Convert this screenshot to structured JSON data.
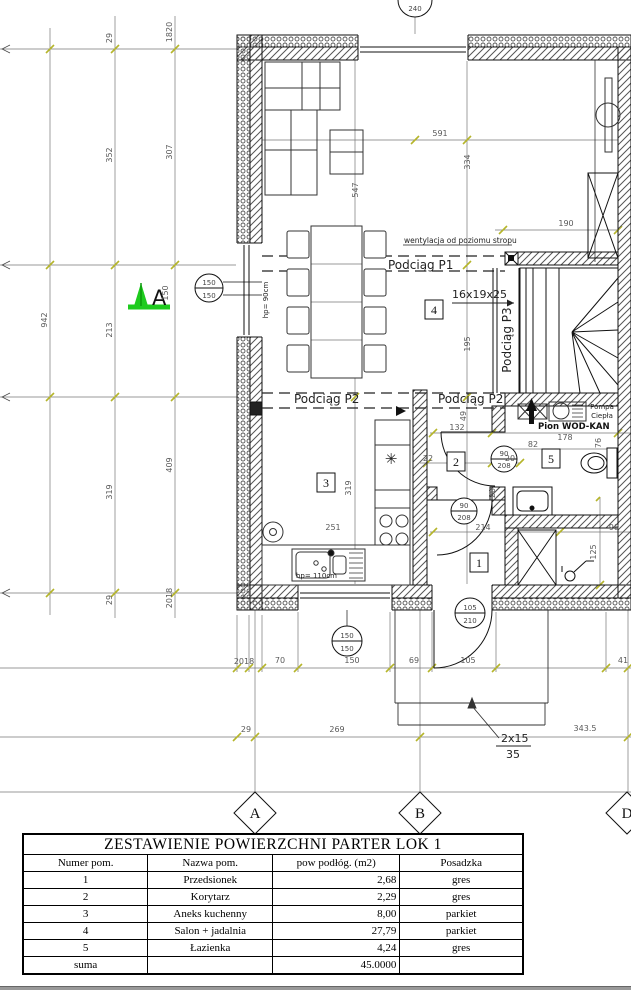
{
  "plan": {
    "section_label": "A",
    "axes": {
      "a": "A",
      "b": "B",
      "d": "D"
    },
    "rooms": {
      "r1": "1",
      "r2": "2",
      "r3": "3",
      "r4": "4",
      "r5": "5"
    },
    "labels": {
      "wentylacja": "wentylacja od poziomu stropu",
      "podciag_p1": "Podciąg P1",
      "podciag_p2": "Podciąg P2",
      "podciag_p3": "Podciąg P3",
      "stair_spec": "16x19x25",
      "step_top": "2x15",
      "step_bottom": "35",
      "pompa_line1": "Pompa",
      "pompa_line2": "Ciepła",
      "pion_wodkan": "Pion WOD-KAN",
      "hp90": "hp= 90cm",
      "hp110": "hp= 110cm"
    },
    "tags": {
      "w240": "240",
      "w150": "150",
      "door_entry_w": "105",
      "door_entry_h": "210",
      "door_int_w": "90",
      "door_int_h": "208"
    },
    "dims": {
      "left_29_top": "29",
      "left_1820": "1820",
      "left_352": "352",
      "left_307": "307",
      "left_942": "942",
      "left_213": "213",
      "left_150": "150",
      "left_319": "319",
      "left_409": "409",
      "left_29_bottom": "29",
      "left_2018": "2018",
      "d591": "591",
      "d334": "334",
      "d547": "547",
      "d190": "190",
      "d195": "195",
      "d132": "132",
      "d178": "178",
      "d82": "82",
      "d22": "22",
      "d20": "20",
      "d49": "49",
      "d76": "76",
      "d214": "214",
      "d98": "98",
      "d125": "125",
      "d251": "251",
      "d319": "319",
      "b2018": "2018",
      "b70": "70",
      "b150": "150",
      "b69": "69",
      "b105": "105",
      "b41": "41",
      "c29": "29",
      "c269": "269",
      "c3435": "343.5"
    }
  },
  "table": {
    "title": "ZESTAWIENIE POWIERZCHNI PARTER LOK 1",
    "headers": [
      "Numer pom.",
      "Nazwa pom.",
      "pow podłóg. (m2)",
      "Posadzka"
    ],
    "rows": [
      [
        "1",
        "Przedsionek",
        "2,68",
        "gres"
      ],
      [
        "2",
        "Korytarz",
        "2,29",
        "gres"
      ],
      [
        "3",
        "Aneks kuchenny",
        "8,00",
        "parkiet"
      ],
      [
        "4",
        "Salon + jadalnia",
        "27,79",
        "parkiet"
      ],
      [
        "5",
        "Łazienka",
        "4,24",
        "gres"
      ]
    ],
    "sum_label": "suma",
    "sum_value": "45.0000"
  }
}
